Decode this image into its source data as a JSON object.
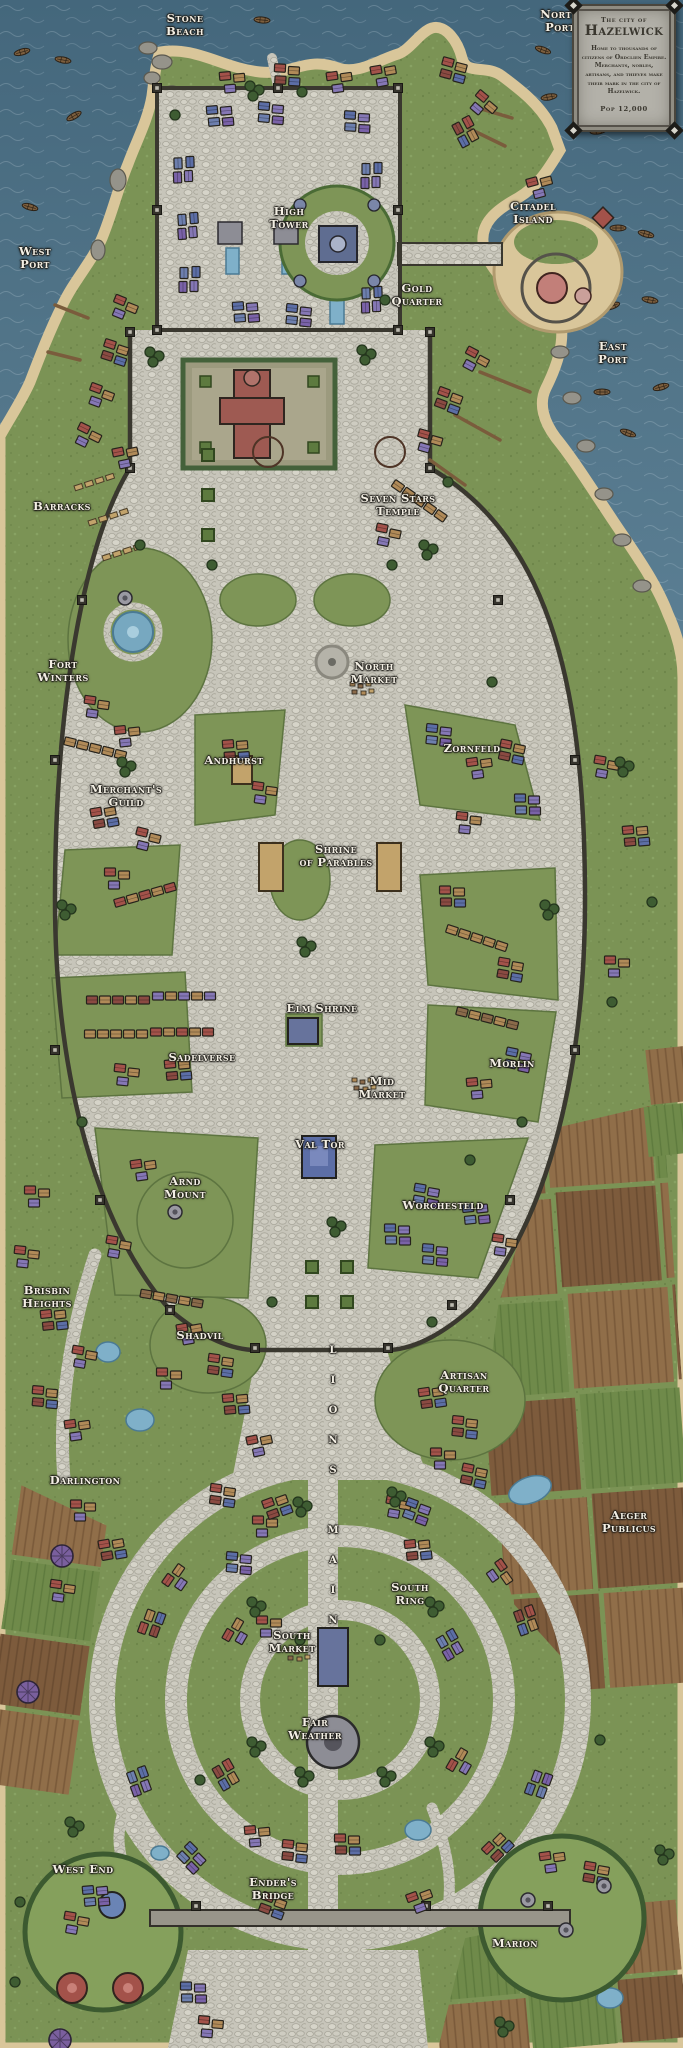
{
  "map": {
    "cartouche": {
      "kicker": "The city of",
      "title": "Hazelwick",
      "body": "Home to thousands of citizens of Ordclien Empire. Merchants, nobles, artisans, and thieves make their mark in the city of Hazelwick.",
      "population": "Pop 12,000"
    },
    "labels": [
      {
        "name": "stone-beach",
        "text": "Stone\nBeach"
      },
      {
        "name": "north-port",
        "text": "North\nPort"
      },
      {
        "name": "west-port",
        "text": "West\nPort"
      },
      {
        "name": "citadel-island",
        "text": "Citadel\nIsland"
      },
      {
        "name": "east-port",
        "text": "East\nPort"
      },
      {
        "name": "high-tower",
        "text": "High\nTower"
      },
      {
        "name": "gold-quarter",
        "text": "Gold\nQuarter"
      },
      {
        "name": "barracks",
        "text": "Barracks"
      },
      {
        "name": "seven-stars-temple",
        "text": "Seven Stars\nTemple"
      },
      {
        "name": "fort-winters",
        "text": "Fort\nWinters"
      },
      {
        "name": "north-market",
        "text": "North\nMarket"
      },
      {
        "name": "andhurst",
        "text": "Andhurst"
      },
      {
        "name": "zornfeld",
        "text": "Zornfeld"
      },
      {
        "name": "merchants-guild",
        "text": "Merchant's\nGuild"
      },
      {
        "name": "shrine-of-parables",
        "text": "Shrine\nof Parables"
      },
      {
        "name": "elm-shrine",
        "text": "Elm Shrine"
      },
      {
        "name": "sadelverse",
        "text": "Sadelverse"
      },
      {
        "name": "morlin",
        "text": "Morlin"
      },
      {
        "name": "mid-market",
        "text": "Mid\nMarket"
      },
      {
        "name": "val-tor",
        "text": "Val Tor"
      },
      {
        "name": "arnd-mount",
        "text": "Arnd\nMount"
      },
      {
        "name": "worchesteld",
        "text": "Worchesteld"
      },
      {
        "name": "brisbin-heights",
        "text": "Brisbin\nHeights"
      },
      {
        "name": "shadvil",
        "text": "Shadvil"
      },
      {
        "name": "artisan-quarter",
        "text": "Artisan\nQuarter"
      },
      {
        "name": "darlington",
        "text": "Darlington"
      },
      {
        "name": "lions-main",
        "text": "L\nI\nO\nN\nS\n\nM\nA\nI\nN"
      },
      {
        "name": "aeger-publicus",
        "text": "Aeger\nPublicus"
      },
      {
        "name": "south-ring",
        "text": "South\nRing"
      },
      {
        "name": "south-market",
        "text": "South\nMarket"
      },
      {
        "name": "fair-weather",
        "text": "Fair\nWeather"
      },
      {
        "name": "west-end",
        "text": "West End"
      },
      {
        "name": "enders-bridge",
        "text": "Ender's\nBridge"
      },
      {
        "name": "marion",
        "text": "Marion"
      }
    ],
    "colors": {
      "sea": "#4e7186",
      "land_green": "#7b9355",
      "forest_green": "#3e5c32",
      "cobblestone": "#c7c5ba",
      "sand": "#d9c69a",
      "wall": "#3a382f",
      "roof_red": "#a3524a",
      "roof_blue": "#5c6ea6",
      "roof_purple": "#8577b5",
      "roof_tan": "#b08a58",
      "field_brown": "#7d5b3c",
      "water_feature": "#7fb0c9",
      "label_text": "#f3efe4",
      "cartouche_bg": "#b3b1a9"
    }
  }
}
